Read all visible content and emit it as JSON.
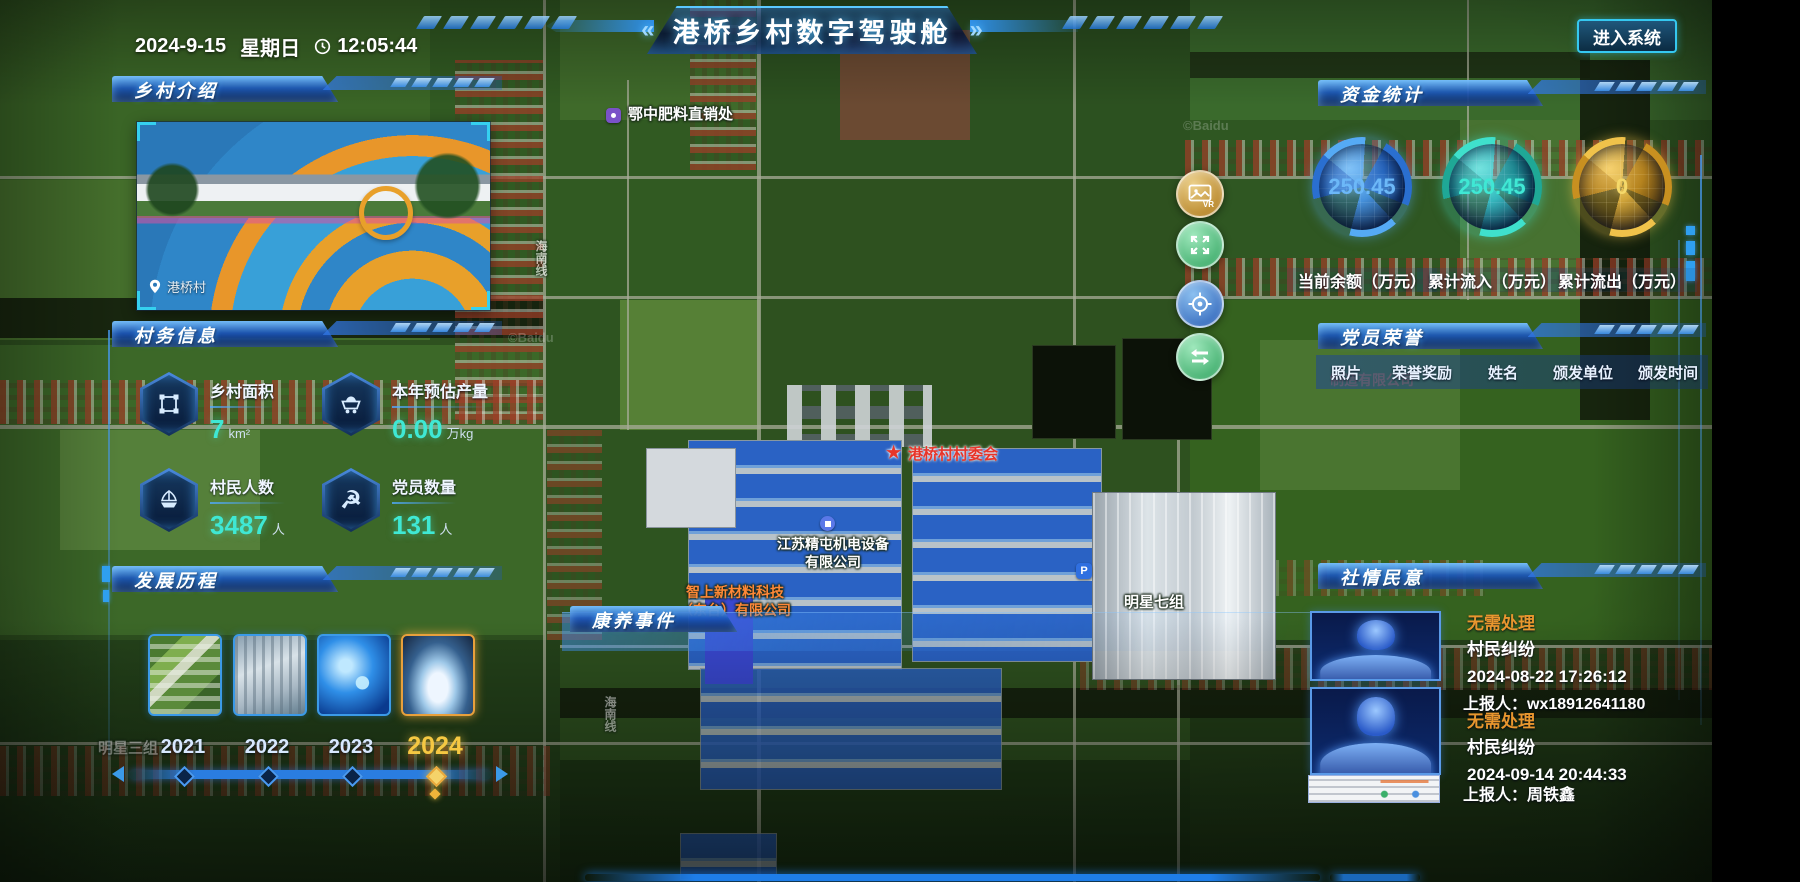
{
  "theme": {
    "accent_cyan": "#35d0f0",
    "panel_blue": "#2a7de0",
    "status_orange": "#e8962e",
    "gold": "#f0c24a"
  },
  "header": {
    "date": "2024-9-15",
    "weekday": "星期日",
    "time": "12:05:44",
    "left_chevron": "«",
    "right_chevron": "»",
    "title": "港桥乡村数字驾驶舱",
    "enter_button": "进入系统"
  },
  "panels": {
    "village_intro": {
      "title": "乡村介绍",
      "photo_caption": "港桥村"
    },
    "village_affairs": {
      "title": "村务信息",
      "stats": [
        {
          "icon": "area-icon",
          "label": "乡村面积",
          "value": "7",
          "unit": "km²"
        },
        {
          "icon": "cart-icon",
          "label": "本年预估产量",
          "value": "0.00",
          "unit": "万kg"
        },
        {
          "icon": "boat-icon",
          "label": "村民人数",
          "value": "3487",
          "unit": "人"
        },
        {
          "icon": "party-icon",
          "label": "党员数量",
          "value": "131",
          "unit": "人"
        }
      ]
    },
    "development": {
      "title": "发展历程",
      "years": [
        {
          "year": "2021",
          "active": false
        },
        {
          "year": "2022",
          "active": false
        },
        {
          "year": "2023",
          "active": false
        },
        {
          "year": "2024",
          "active": true
        }
      ]
    },
    "funds": {
      "title": "资金统计",
      "gauges": [
        {
          "value": "250.45",
          "label": "当前余额（万元）",
          "color": "#4aa0f0"
        },
        {
          "value": "250.45",
          "label": "累计流入（万元）",
          "color": "#2fd8c6"
        },
        {
          "value": "0",
          "label": "累计流出（万元）",
          "color": "#e8b83c"
        }
      ]
    },
    "party_honors": {
      "title": "党员荣誉",
      "columns": [
        "照片",
        "荣誉奖励",
        "姓名",
        "颁发单位",
        "颁发时间"
      ],
      "rows": []
    },
    "public_opinion": {
      "title": "社情民意",
      "items": [
        {
          "status": "无需处理",
          "type": "村民纠纷",
          "datetime": "2024-08-22 17:26:12",
          "reporter": "上报人：wx18912641180"
        },
        {
          "status": "无需处理",
          "type": "村民纠纷",
          "datetime": "2024-09-14 20:44:33",
          "reporter": "上报人：周铁鑫"
        }
      ]
    },
    "health_events": {
      "title": "康养事件"
    }
  },
  "map": {
    "watermark": "©Baidu",
    "road_label": "海南线",
    "vr_text": "VR",
    "labels": {
      "fertilizer": "鄂中肥料直销处",
      "committee": "港桥村村委会",
      "company1": "江苏精屯机电设备\n有限公司",
      "company2": "智上新材料科技\n（东台）有限公司",
      "group7": "明星七组",
      "group3": "明星三组",
      "factory_faint": "制造有限公司",
      "parking": "P"
    }
  }
}
